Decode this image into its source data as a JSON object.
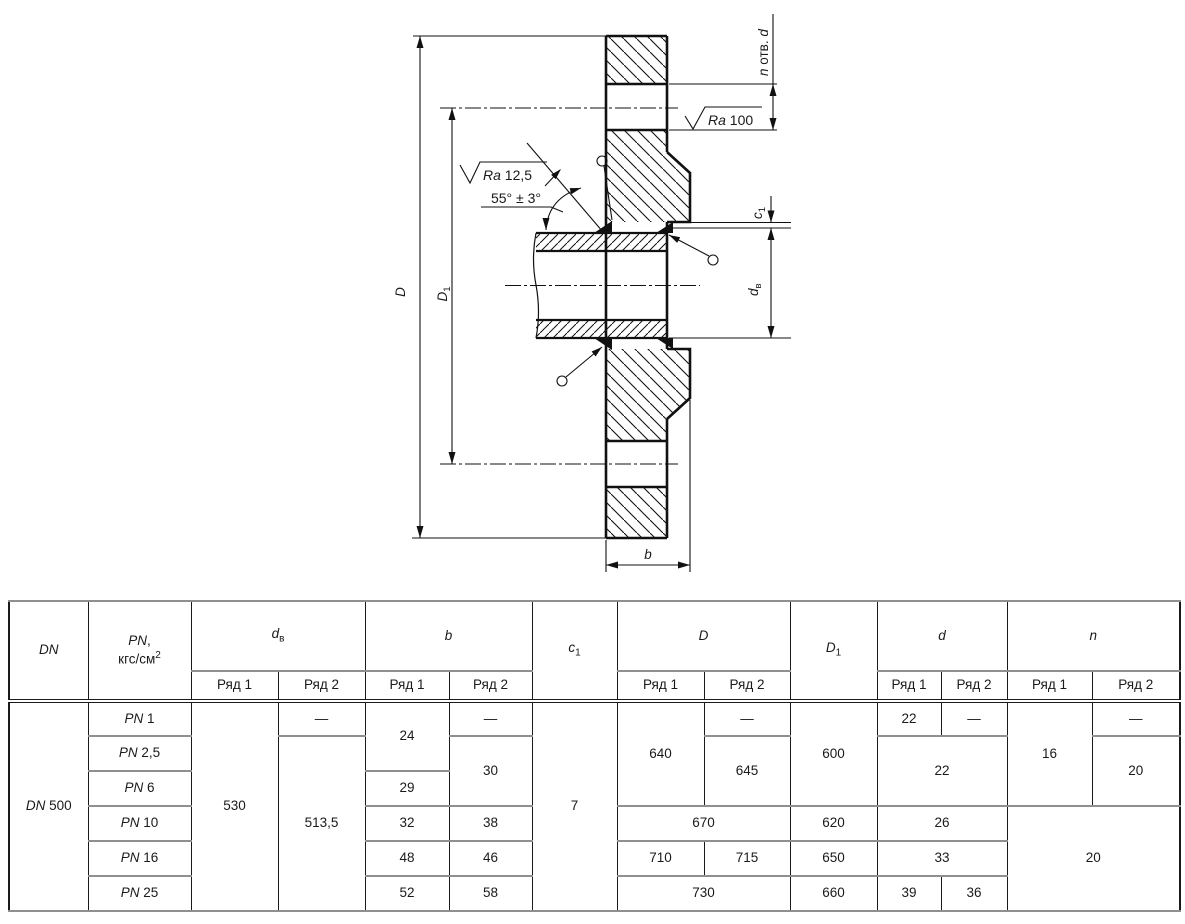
{
  "drawing": {
    "labels": {
      "D": "*D*",
      "D1": "*D*~1~",
      "b": "*b*",
      "c1": "*c*~1~",
      "dv": "*d*~в~",
      "n_holes": "*n* отв. *d*",
      "ra100": "*Ra* 100",
      "ra125": "*Ra* 12,5",
      "angle": "55° ± 3°"
    }
  },
  "table": {
    "header_row1": [
      {
        "t": "*DN*",
        "rs": 2
      },
      {
        "t": "*PN*,\nкгс/см^2^",
        "rs": 2
      },
      {
        "t": "*d*~в~",
        "cs": 2
      },
      {
        "t": "*b*",
        "cs": 2
      },
      {
        "t": "*c*~1~",
        "rs": 2
      },
      {
        "t": "*D*",
        "cs": 2
      },
      {
        "t": "*D*~1~",
        "rs": 2
      },
      {
        "t": "*d*",
        "cs": 2
      },
      {
        "t": "*n*",
        "cs": 2
      }
    ],
    "header_row2": [
      "Ряд 1",
      "Ряд 2",
      "Ряд 1",
      "Ряд 2",
      "Ряд 1",
      "Ряд 2",
      "Ряд 1",
      "Ряд 2",
      "Ряд 1",
      "Ряд 2"
    ],
    "rows": [
      [
        {
          "t": "*DN* 500",
          "rs": 6
        },
        {
          "t": "*PN* 1"
        },
        {
          "t": "530",
          "rs": 6
        },
        {
          "t": "—"
        },
        {
          "t": "24",
          "rs": 2
        },
        {
          "t": "—"
        },
        {
          "t": "7",
          "rs": 6
        },
        {
          "t": "640",
          "rs": 3
        },
        {
          "t": "—"
        },
        {
          "t": "600",
          "rs": 3
        },
        {
          "t": "22"
        },
        {
          "t": "—"
        },
        {
          "t": "16",
          "rs": 3
        },
        {
          "t": "—"
        }
      ],
      [
        {
          "t": "*PN* 2,5"
        },
        {
          "t": "513,5",
          "rs": 5
        },
        {
          "t": "30",
          "rs": 2
        },
        {
          "t": "645",
          "rs": 2
        },
        {
          "t": "22",
          "cs": 2,
          "rs": 2
        },
        {
          "t": "20",
          "rs": 2
        }
      ],
      [
        {
          "t": "*PN* 6"
        },
        {
          "t": "29"
        }
      ],
      [
        {
          "t": "*PN* 10"
        },
        {
          "t": "32"
        },
        {
          "t": "38"
        },
        {
          "t": "670",
          "cs": 2
        },
        {
          "t": "620"
        },
        {
          "t": "26",
          "cs": 2
        },
        {
          "t": "20",
          "cs": 2,
          "rs": 3
        }
      ],
      [
        {
          "t": "*PN* 16"
        },
        {
          "t": "48"
        },
        {
          "t": "46"
        },
        {
          "t": "710"
        },
        {
          "t": "715"
        },
        {
          "t": "650"
        },
        {
          "t": "33",
          "cs": 2
        }
      ],
      [
        {
          "t": "*PN* 25"
        },
        {
          "t": "52"
        },
        {
          "t": "58"
        },
        {
          "t": "730",
          "cs": 2
        },
        {
          "t": "660"
        },
        {
          "t": "39"
        },
        {
          "t": "36"
        }
      ]
    ]
  }
}
